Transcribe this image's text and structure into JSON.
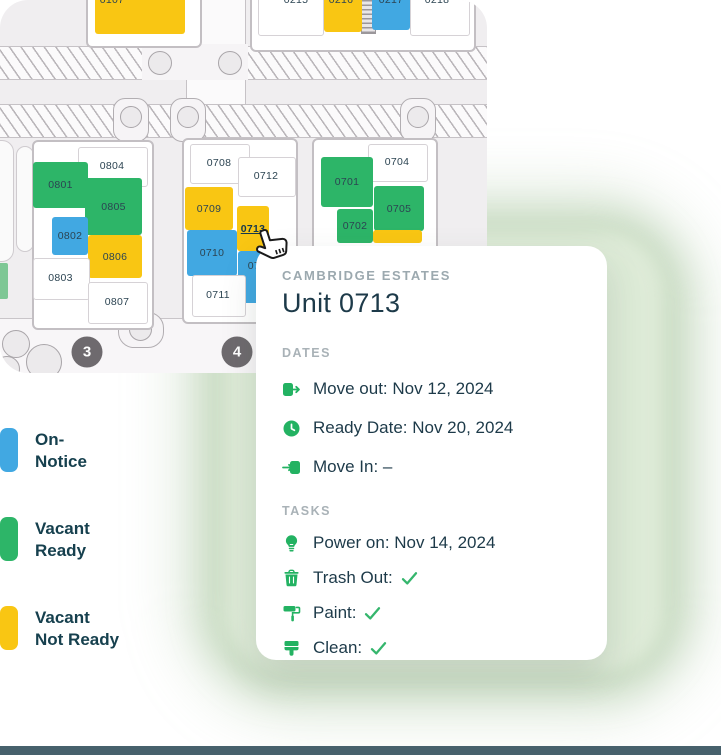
{
  "status_colors": {
    "on-notice": "#41a8e2",
    "vacant-ready": "#2db568",
    "vacant-not-ready": "#f9c613",
    "occupied": "#ffffff"
  },
  "map": {
    "selected_unit": "0713",
    "building_markers": [
      {
        "label": "3",
        "x": 87,
        "y": 352
      },
      {
        "label": "4",
        "x": 237,
        "y": 352
      }
    ],
    "units": [
      {
        "label": "0107",
        "status": "vacant-not-ready",
        "x": 95,
        "y": -8,
        "w": 90,
        "h": 42,
        "lx": 112,
        "ly": 0
      },
      {
        "label": "0215",
        "status": "occupied",
        "x": 258,
        "y": -8,
        "w": 64,
        "h": 42,
        "lx": 296,
        "ly": 0
      },
      {
        "label": "0216",
        "status": "vacant-not-ready",
        "x": 324,
        "y": -8,
        "w": 38,
        "h": 40,
        "lx": 341,
        "ly": 0
      },
      {
        "label": "0217",
        "status": "on-notice",
        "x": 372,
        "y": -8,
        "w": 38,
        "h": 38,
        "lx": 391,
        "ly": 0
      },
      {
        "label": "0218",
        "status": "occupied",
        "x": 410,
        "y": -8,
        "w": 58,
        "h": 42,
        "lx": 437,
        "ly": 0
      },
      {
        "label": "0804",
        "status": "occupied",
        "x": 78,
        "y": 147,
        "w": 68,
        "h": 38
      },
      {
        "label": "0801",
        "status": "vacant-ready",
        "x": 33,
        "y": 162,
        "w": 55,
        "h": 46
      },
      {
        "label": "0805",
        "status": "vacant-ready",
        "x": 85,
        "y": 178,
        "w": 57,
        "h": 57
      },
      {
        "label": "0802",
        "status": "on-notice",
        "x": 52,
        "y": 217,
        "w": 36,
        "h": 38
      },
      {
        "label": "0806",
        "status": "vacant-not-ready",
        "x": 88,
        "y": 235,
        "w": 54,
        "h": 43
      },
      {
        "label": "0803",
        "status": "occupied",
        "x": 33,
        "y": 258,
        "w": 55,
        "h": 40
      },
      {
        "label": "0807",
        "status": "occupied",
        "x": 88,
        "y": 282,
        "w": 58,
        "h": 40
      },
      {
        "label": "0708",
        "status": "occupied",
        "x": 190,
        "y": 144,
        "w": 58,
        "h": 38
      },
      {
        "label": "0712",
        "status": "occupied",
        "x": 238,
        "y": 157,
        "w": 56,
        "h": 38
      },
      {
        "label": "0709",
        "status": "vacant-not-ready",
        "x": 185,
        "y": 187,
        "w": 48,
        "h": 43
      },
      {
        "label": "0713",
        "status": "vacant-not-ready",
        "x": 237,
        "y": 206,
        "w": 32,
        "h": 45,
        "selected": true
      },
      {
        "label": "0710",
        "status": "on-notice",
        "x": 187,
        "y": 230,
        "w": 50,
        "h": 46
      },
      {
        "label": "0714",
        "status": "on-notice",
        "x": 238,
        "y": 251,
        "w": 28,
        "h": 52,
        "lx": 260,
        "ly": 266
      },
      {
        "label": "0711",
        "status": "occupied",
        "x": 192,
        "y": 275,
        "w": 52,
        "h": 40
      },
      {
        "label": "0704",
        "status": "occupied",
        "x": 368,
        "y": 144,
        "w": 58,
        "h": 36
      },
      {
        "label": "0701",
        "status": "vacant-ready",
        "x": 321,
        "y": 157,
        "w": 52,
        "h": 50
      },
      {
        "label": "0705",
        "status": "vacant-ready",
        "x": 374,
        "y": 186,
        "w": 50,
        "h": 45
      },
      {
        "label": "0702",
        "status": "vacant-ready",
        "x": 337,
        "y": 209,
        "w": 36,
        "h": 34
      },
      {
        "label": "0706",
        "status": "vacant-not-ready",
        "x": 373,
        "y": 230,
        "w": 49,
        "h": 13,
        "nolabel": true
      }
    ]
  },
  "legend": {
    "items": [
      {
        "label": "On-\nNotice",
        "status": "on-notice"
      },
      {
        "label": "Vacant\nReady",
        "status": "vacant-ready"
      },
      {
        "label": "Vacant\nNot Ready",
        "status": "vacant-not-ready"
      }
    ]
  },
  "card": {
    "eyebrow": "CAMBRIDGE ESTATES",
    "title": "Unit 0713",
    "sections": [
      {
        "id": "dates",
        "label": "DATES",
        "rows": [
          {
            "icon": "move-out",
            "text": "Move out: Nov 12, 2024"
          },
          {
            "icon": "clock",
            "text": "Ready Date: Nov 20, 2024"
          },
          {
            "icon": "move-in",
            "text": "Move In: –"
          }
        ]
      },
      {
        "id": "tasks",
        "label": "TASKS",
        "rows": [
          {
            "icon": "bulb",
            "text": "Power on: Nov 14, 2024"
          },
          {
            "icon": "trash",
            "text": "Trash Out:",
            "check": true
          },
          {
            "icon": "paint-roller",
            "text": "Paint:",
            "check": true
          },
          {
            "icon": "brush",
            "text": "Clean:",
            "check": true
          }
        ]
      }
    ]
  }
}
